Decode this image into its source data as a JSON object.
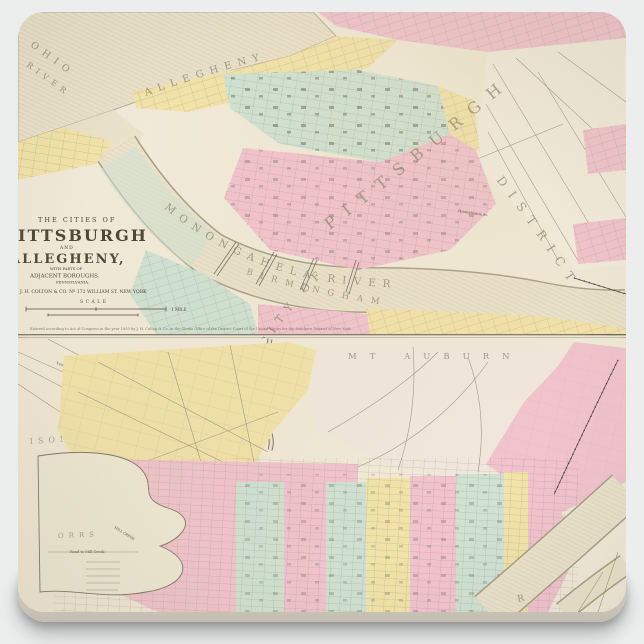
{
  "product": {
    "description": "Square stone coaster printed with a vintage two-panel city map",
    "background_color": "#eceded",
    "coaster_color": "#f1ead8"
  },
  "palette": {
    "paper": "#f1ead8",
    "river": "#eae2cb",
    "river_edge": "#a89e85",
    "pink": "#f2c3ce",
    "yellow": "#f2e3a9",
    "teal": "#cfe2d3",
    "cream_district": "#f3eddf",
    "mt_auburn_cream": "#f1e7dd",
    "label": "#8d8370",
    "ink": "#4a4336",
    "street": "#8a8070",
    "divider": "#57503f",
    "page_bg": "#eceded",
    "coaster_side": "#d9d4c7"
  },
  "upper_map": {
    "title_block": {
      "line1": "THE CITIES OF",
      "line2": "PITTSBURGH",
      "line3": "AND",
      "line4": "ALLEGHENY,",
      "line5": "WITH PARTS OF",
      "line6": "ADJACENT BOROUGHS.",
      "line7": "PENNSYLVANIA.",
      "publisher": "J. H. COLTON & CO. Nº 172 WILLIAM ST. NEW YORK",
      "scale_label": "SCALE",
      "scale_mile": "1 MILE",
      "copyright": "Entered according to Act of Congress in the year 1855 by J. H. Colton & Co. in the Clerks Office of the District Court of the United States for the Southern District of New York."
    },
    "labels": {
      "ohio_word1": "OHIO",
      "ohio_word2": "RIVER",
      "allegheny_river": "ALLEGHENY",
      "monongahela_river": "MONONGAHELA RIVER",
      "pittsburgh_big": "PITTSBURGH",
      "city_of": "CITY OF",
      "district": "DISTRICT",
      "birmingham": "BIRMINGHAM",
      "pennsylvania_av": "Pennsylvania Av."
    }
  },
  "lower_map": {
    "labels": {
      "mt_auburn": "MT AUBURN",
      "ison": "ISON",
      "orrs": "ORRS",
      "turnpike1": "Turnpike",
      "turnpike2": "Turnpike",
      "mill_creek": "MILL CREEK",
      "road_to_mill_creek": "Road to Mill Creek",
      "hopkins": "Hopkins St.",
      "river_letter": "R"
    }
  }
}
